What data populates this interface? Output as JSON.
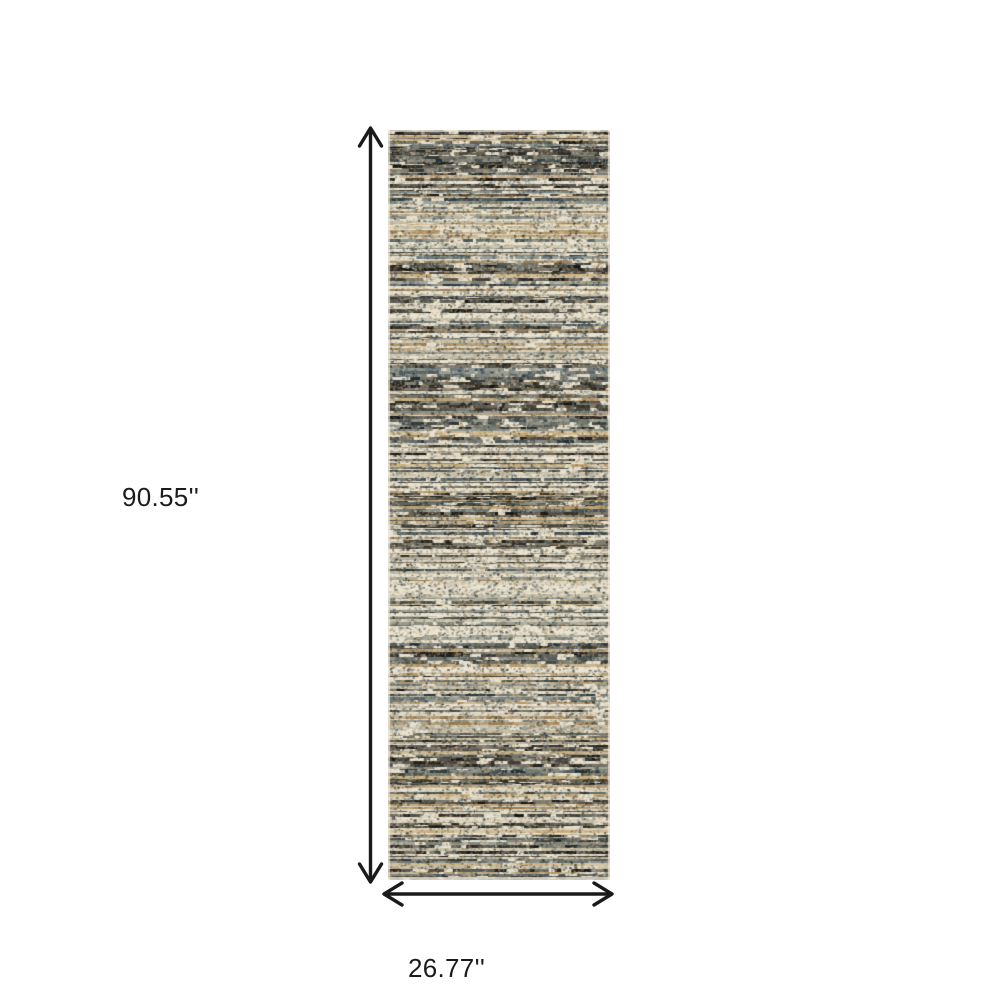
{
  "figure": {
    "type": "product-dimension-diagram",
    "background": "#ffffff",
    "annotation_color": "#1a1a1a",
    "height_dimension": {
      "label": "90.55''",
      "orientation": "vertical"
    },
    "width_dimension": {
      "label": "26.77''",
      "orientation": "horizontal"
    }
  },
  "rug": {
    "description": "Distressed multicolor horizontal-striped runner rug shown upright",
    "base_color": "#e8e1cf",
    "fringe_color": "#f0ead9",
    "dark_colors": [
      [
        "#14120d",
        5
      ],
      [
        "#26241c",
        3
      ],
      [
        "#30352f",
        2
      ],
      [
        "#1f2e36",
        2
      ]
    ],
    "light_colors": [
      [
        "#ece5d3",
        5
      ],
      [
        "#d8d1bc",
        3
      ],
      [
        "#c0b9a3",
        2
      ],
      [
        "#aaa391",
        1
      ]
    ],
    "accent_colors": [
      [
        "#b2915e",
        3
      ],
      [
        "#97784a",
        2
      ],
      [
        "#c9ab76",
        2
      ],
      [
        "#3e5058",
        2
      ],
      [
        "#5d7076",
        1
      ],
      [
        "#7b8279",
        2
      ]
    ]
  }
}
